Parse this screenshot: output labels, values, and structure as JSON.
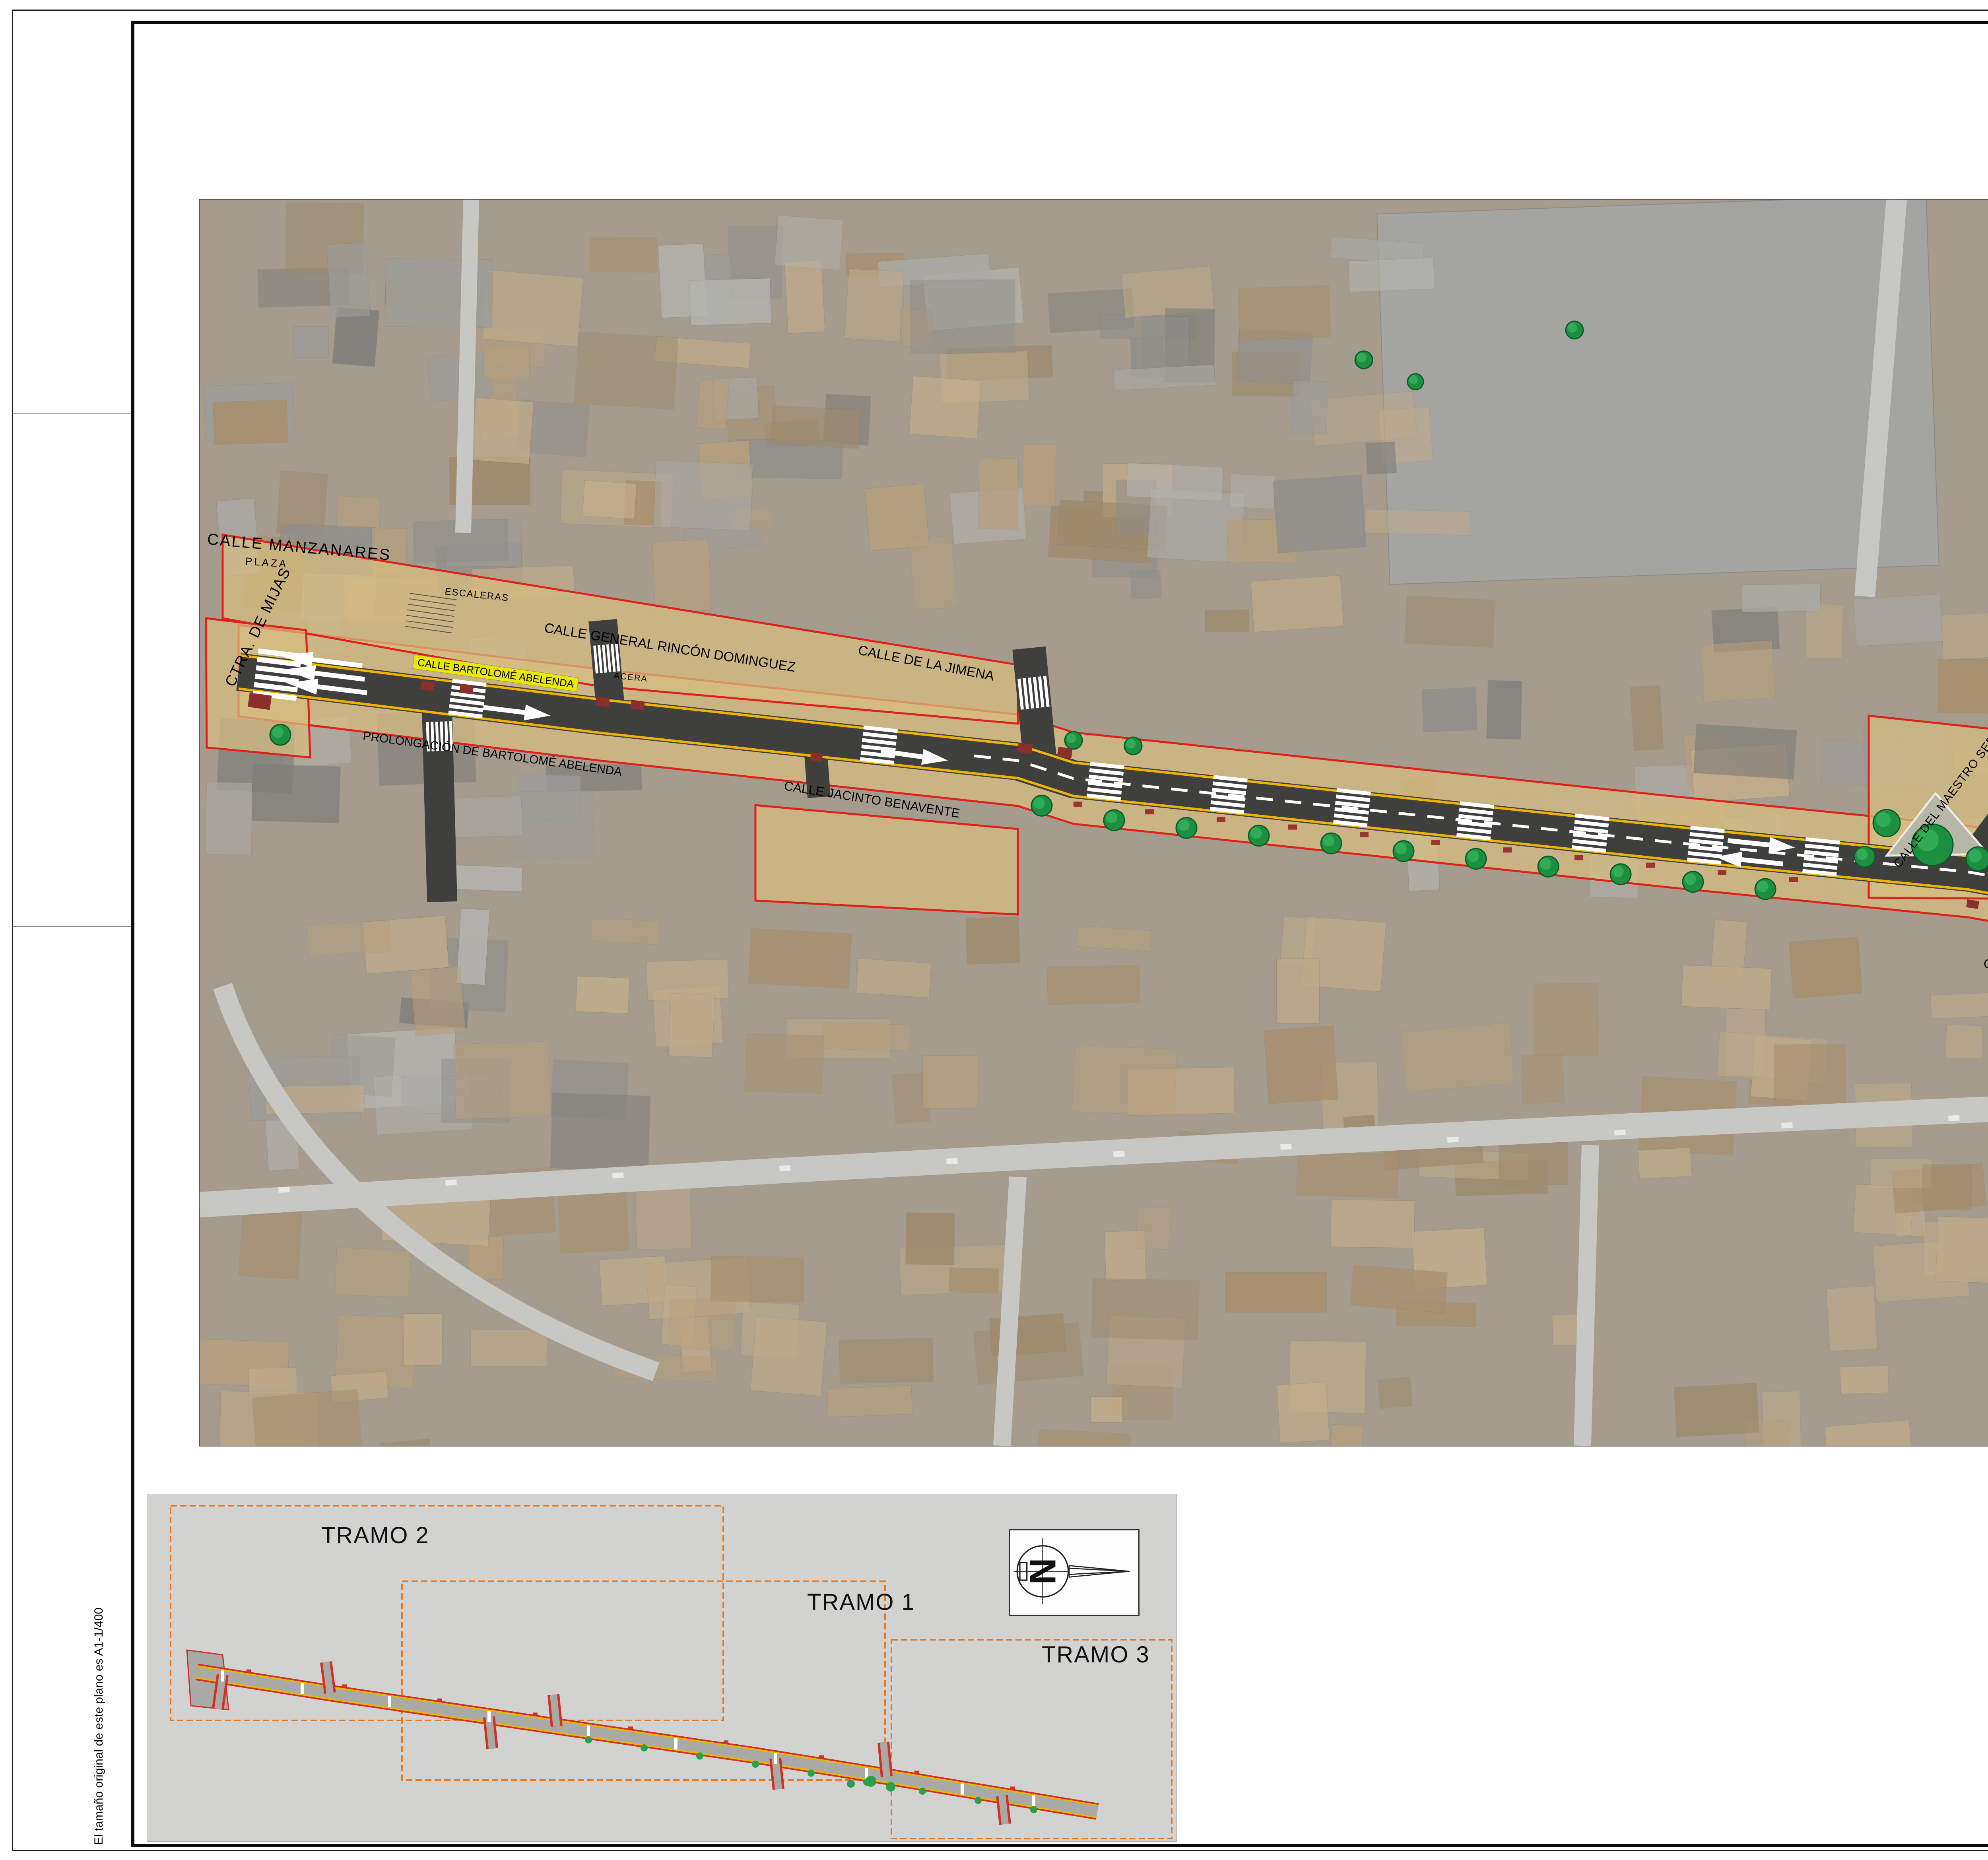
{
  "sheet": {
    "size_note": "El tamaño original de este plano es A1-1/400"
  },
  "north": {
    "label": "N"
  },
  "map_labels": {
    "manzanares": "CALLE MANZANARES",
    "ctra_mijas": "CTRA. DE MIJAS",
    "plaza": "PLAZA",
    "escaleras": "ESCALERAS",
    "acera1": "ACERA",
    "acera2": "ACERA",
    "acera3": "ACERA",
    "rincon": "CALLE GENERAL RINCÓN DOMINGUEZ",
    "jimena": "CALLE DE LA JIMENA",
    "prolongacion": "PROLONGACIÓN DE BARTOLOMÉ ABELENDA",
    "jacinto": "CALLE JACINTO BENAVENTE",
    "bartolome1": "CALLE BARTOLOMÉ ABELENDA",
    "bartolome2": "CALLE BARTOLOMÉ ABELENDA",
    "maestro": "CALLE DEL MAESTRO SERRANO",
    "pozo": "CALLE POZO SOLÍS",
    "ramiro": "CALLE RAMIRO LEDESMA",
    "reyes": "CALLE REYES CATÓLICOS"
  },
  "inset": {
    "tramo1": "TRAMO 1",
    "tramo2": "TRAMO 2",
    "tramo3": "TRAMO 3",
    "north_label": "N"
  },
  "legend": {
    "limit_label": "LÍMITE DE ACTUACIÓN",
    "tramo_label": "TRAMO"
  },
  "title_block": {
    "org_line1": "EXCMO. AYUNTAMIENTO",
    "org_line2": "DE C O I N",
    "office": "Oficina Técnica",
    "contenido_label": "CONTENIDO",
    "content_line1": "PAEM 2022 1ª FASE  REMODELACIÓN",
    "content_line2": "CALLE BARTOLOMÉ ABELENDA",
    "content_line3": "TRAZADO GENERAL",
    "fecha_label": "FECHA",
    "fecha_value": "DICIEMBRE - 2022",
    "escala_label": "ESCALA",
    "escala_value": "1/400",
    "dibujado_label": "DIBUJADO",
    "dibujado_value": "M.A.J.Q",
    "referencia_label": "REFERENCIA",
    "referencia_value": "P-44/2022",
    "arquitecto_label": "EL ARQUITECTO",
    "firma": "Fdo: Francisco J. Agüera Enríquez",
    "hoja_label": "HOJA Nº",
    "hoja_value": "3.0"
  },
  "colors": {
    "limit_red": "#e0201c",
    "tramo_orange": "#e87b22",
    "road_dark": "#3f3f3d",
    "edge_yellow": "#f0b400",
    "band_tan": "#d8be82",
    "label_yellow": "#e8e800",
    "crest_navy": "#15356e"
  }
}
